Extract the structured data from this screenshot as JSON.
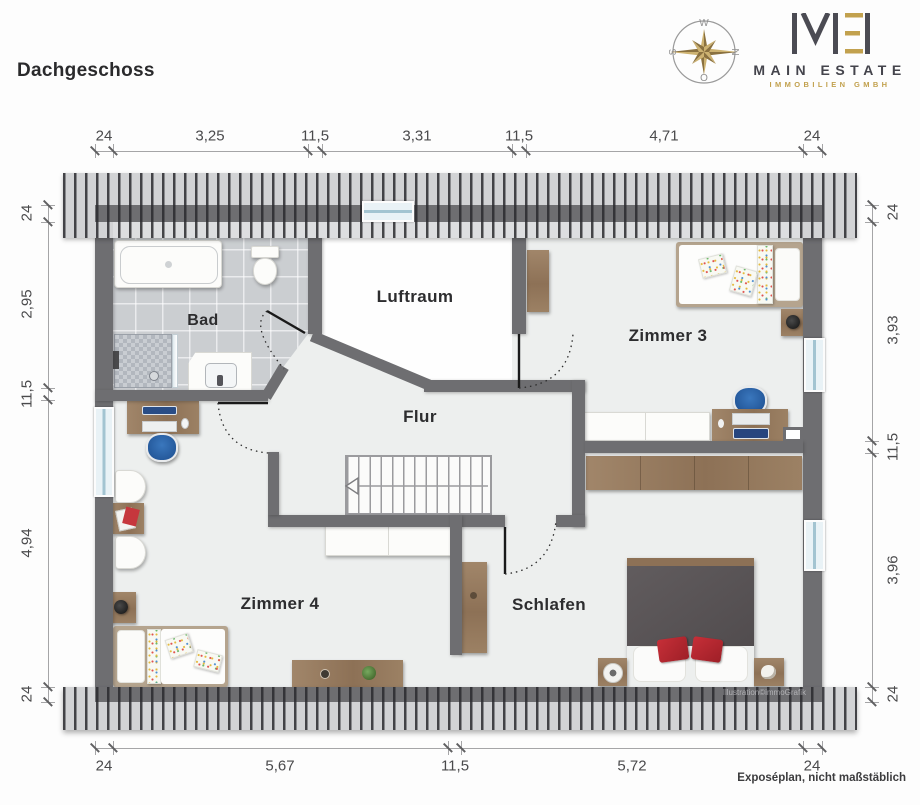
{
  "header": {
    "title": "Dachgeschoss"
  },
  "logo": {
    "name": "MAIN ESTATE",
    "subtitle": "IMMOBILIEN GMBH"
  },
  "compass": {
    "top": "W",
    "right": "N",
    "bottom": "O",
    "left": "S"
  },
  "rooms": {
    "bad": "Bad",
    "luftraum": "Luftraum",
    "zimmer3": "Zimmer 3",
    "flur": "Flur",
    "zimmer4": "Zimmer 4",
    "schlafen": "Schlafen"
  },
  "dims": {
    "top": [
      "24",
      "3,25",
      "11,5",
      "3,31",
      "11,5",
      "4,71",
      "24"
    ],
    "left": [
      "24",
      "2,95",
      "11,5",
      "4,94",
      "24"
    ],
    "right": [
      "24",
      "3,93",
      "11,5",
      "3,96",
      "24"
    ],
    "bottom": [
      "24",
      "5,67",
      "11,5",
      "5,72",
      "24"
    ]
  },
  "footer": {
    "watermark": "Illustration©immoGrafik",
    "note": "Exposéplan, nicht maßstäblich"
  },
  "colors": {
    "wall": "#6e6e71",
    "accent_gold": "#c2a14e",
    "floor": "#edefee",
    "roof_stripe": "#3c3c3f"
  }
}
